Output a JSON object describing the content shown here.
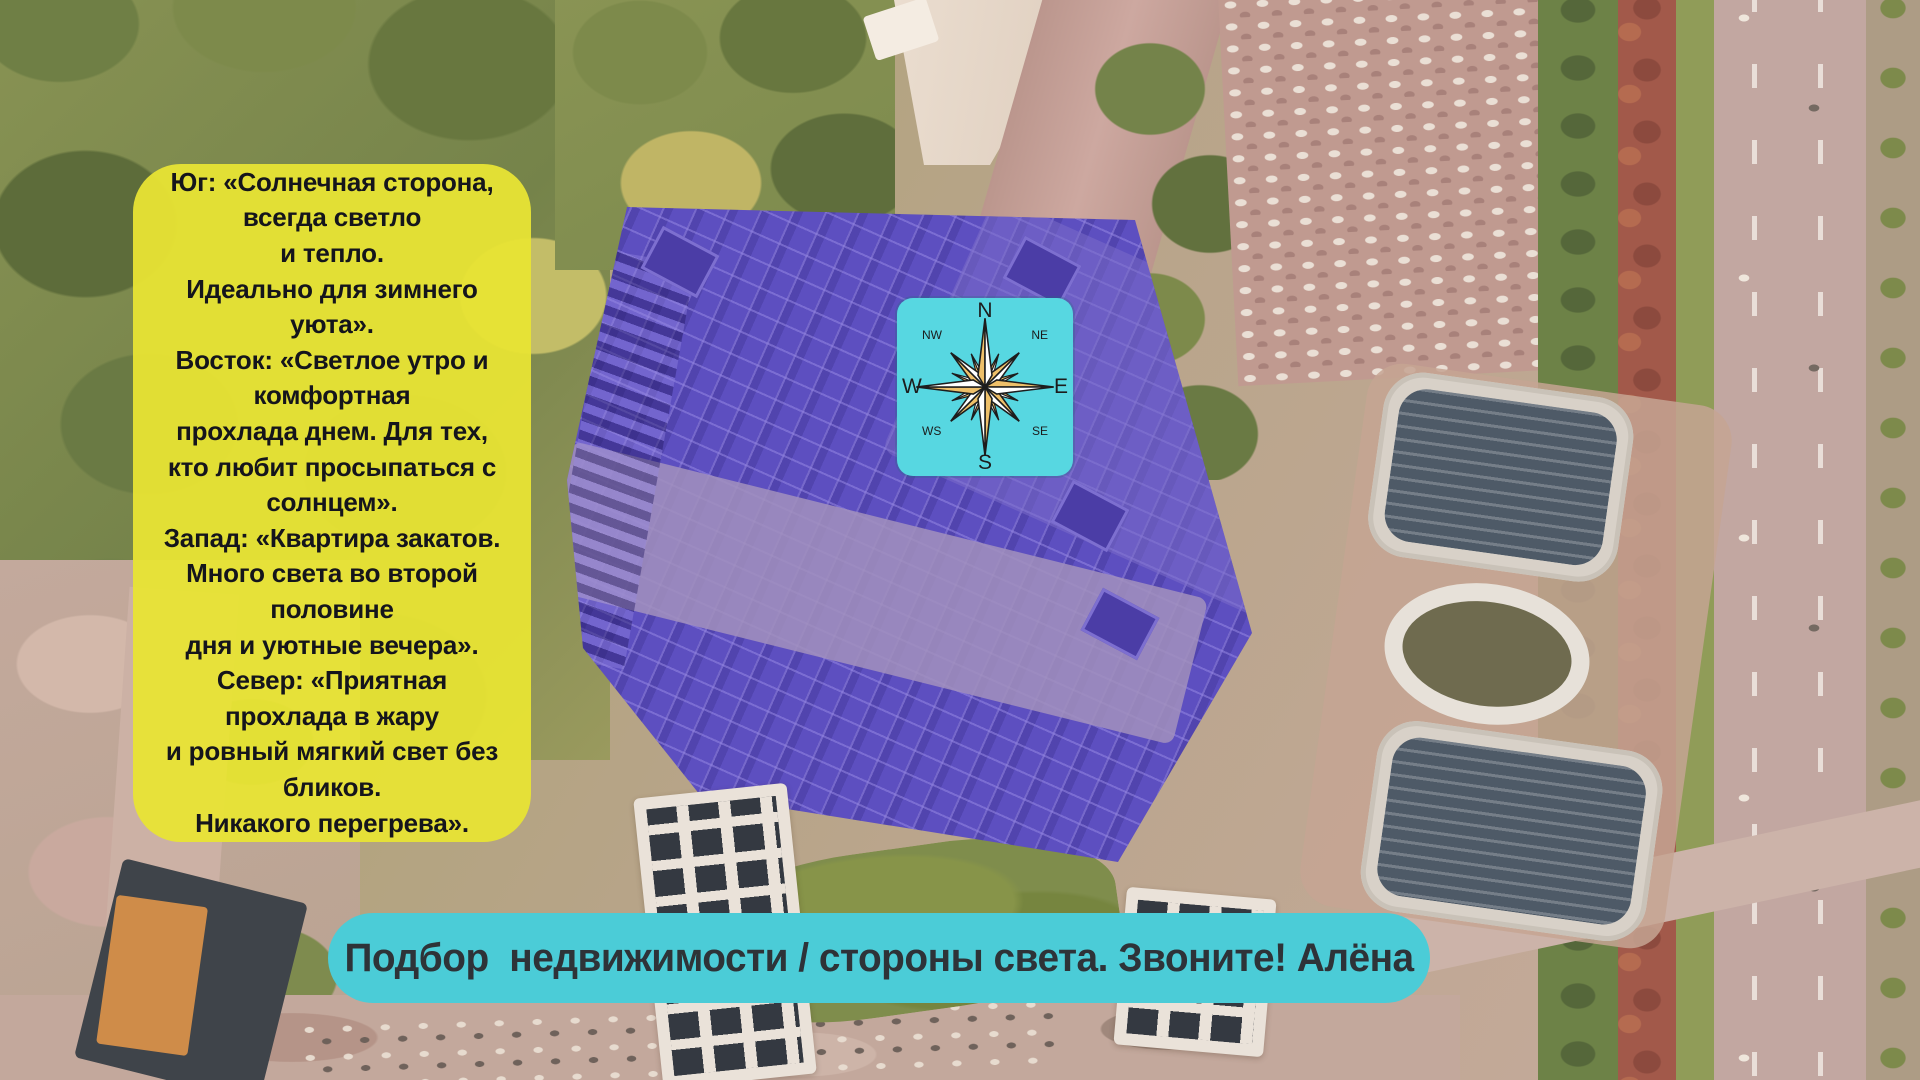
{
  "info_card": {
    "text": "Юг: «Солнечная сторона,\nвсегда светло\nи тепло.\nИдеально для зимнего\nуюта».\nВосток: «Светлое утро и\nкомфортная\nпрохлада днем. Для тех,\nкто любит просыпаться с\nсолнцем».\nЗапад: «Квартира закатов.\nМного света во второй\nполовине\nдня и уютные вечера».\nСевер: «Приятная\nпрохлада в жару\nи ровный мягкий свет без\nбликов.\nНикакого перегрева».",
    "bg_color": "#e8e434"
  },
  "compass": {
    "bg_color": "#57d7e1",
    "labels": {
      "n": "N",
      "ne": "NE",
      "e": "E",
      "se": "SE",
      "s": "S",
      "ws": "WS",
      "w": "W",
      "nw": "NW"
    },
    "rose_colors": {
      "fill": "#eec06a",
      "alt": "#ffffff",
      "outline": "#1d1d1d"
    }
  },
  "banner": {
    "text": "Подбор  недвижимости / стороны света. Звоните! Алёна",
    "bg_color": "#4bccd7",
    "text_color": "#2e3338"
  },
  "scene": {
    "highlight_color": "#5d4fc0"
  }
}
